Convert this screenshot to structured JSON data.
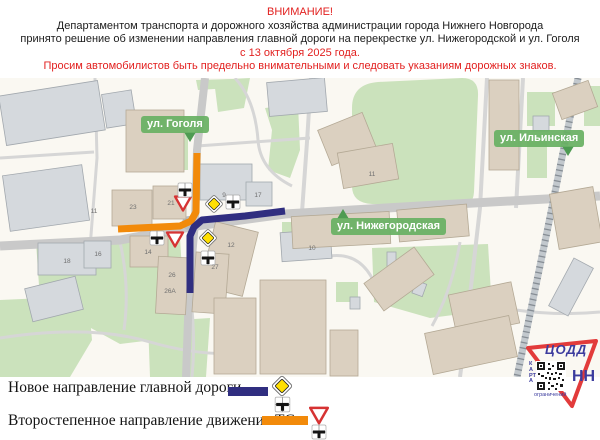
{
  "header": {
    "attention": "ВНИМАНИЕ!",
    "line1": "Департаментом транспорта и дорожного хозяйства администрации города Нижнего Новгорода",
    "line2": "принято решение об изменении направления главной дороги на перекрестке ул. Нижегородской и ул. Гоголя",
    "date_line": "с 13 октября 2025 года.",
    "warning_line": "Просим автомобилистов быть предельно внимательными и следовать указаниям дорожных знаков."
  },
  "map": {
    "street_labels": [
      {
        "id": "gogolya",
        "text": "ул. Гоголя"
      },
      {
        "id": "ilyinskaya",
        "text": "ул. Ильинская"
      },
      {
        "id": "nizhegorodskaya",
        "text": "ул. Нижегородская"
      }
    ],
    "building_numbers": [
      {
        "t": "11",
        "x": 94,
        "y": 213
      },
      {
        "t": "23",
        "x": 133,
        "y": 209
      },
      {
        "t": "21",
        "x": 171,
        "y": 205
      },
      {
        "t": "9",
        "x": 224,
        "y": 197
      },
      {
        "t": "17",
        "x": 258,
        "y": 197
      },
      {
        "t": "11",
        "x": 372,
        "y": 176
      },
      {
        "t": "18",
        "x": 67,
        "y": 263
      },
      {
        "t": "16",
        "x": 98,
        "y": 256
      },
      {
        "t": "14",
        "x": 148,
        "y": 254
      },
      {
        "t": "12",
        "x": 231,
        "y": 247
      },
      {
        "t": "10",
        "x": 312,
        "y": 250
      },
      {
        "t": "26",
        "x": 172,
        "y": 277
      },
      {
        "t": "26А",
        "x": 170,
        "y": 293
      },
      {
        "t": "27",
        "x": 215,
        "y": 269
      }
    ],
    "signs": [
      {
        "type": "priority",
        "x": 214,
        "y": 204
      },
      {
        "type": "priority",
        "x": 208,
        "y": 238
      },
      {
        "type": "giveway",
        "x": 183,
        "y": 203
      },
      {
        "type": "giveway",
        "x": 175,
        "y": 239
      },
      {
        "type": "plate",
        "x": 185,
        "y": 190
      },
      {
        "type": "plate",
        "x": 233,
        "y": 202
      },
      {
        "type": "plate",
        "x": 157,
        "y": 238
      },
      {
        "type": "plate",
        "x": 208,
        "y": 258
      }
    ]
  },
  "legend": {
    "rows": [
      {
        "label": "Новое направление главной дороги -",
        "swatch_color": "#302e80",
        "icons": [
          "priority-road-sign",
          "crossroads-plate"
        ]
      },
      {
        "label": "Второстепенное направление движения ТС -",
        "swatch_color": "#f28a0a",
        "icons": [
          "give-way-sign",
          "crossroads-plate"
        ]
      }
    ]
  },
  "logo": {
    "org": "ЦОДД",
    "city": "НН",
    "qr_side_caption": "КАРТА",
    "qr_bottom_caption": "ограничений"
  },
  "colors": {
    "attention_red": "#e2201f",
    "main_route_navy": "#302e80",
    "secondary_route_orange": "#f28a0a",
    "street_label_green": "#68b063",
    "map_background": "#faf8f2",
    "building_gray": "#d5d9dd",
    "building_tan": "#dbd0c0",
    "green_area": "#cbe2bc",
    "road_gray": "#c9c9c9",
    "sign_yellow": "#ffdf00",
    "give_way_red": "#d63333"
  }
}
